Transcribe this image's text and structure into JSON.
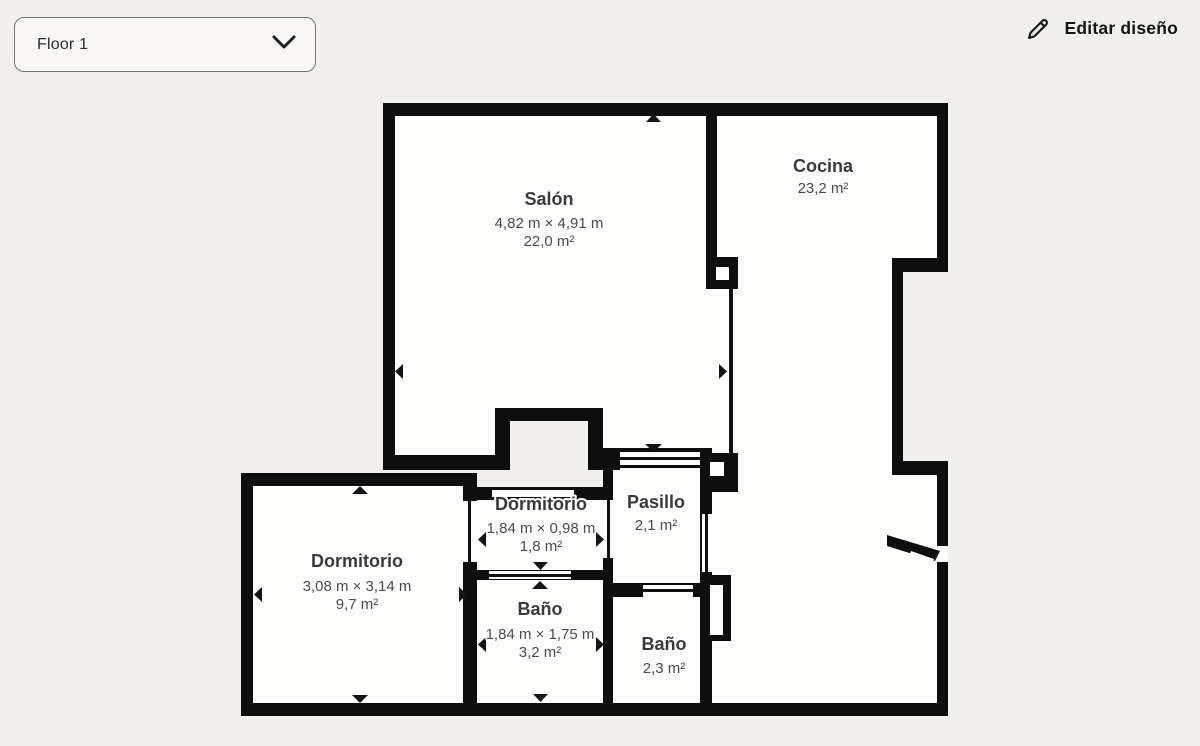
{
  "header": {
    "floor_selector": {
      "label": "Floor 1"
    },
    "edit_button": {
      "label": "Editar diseño"
    }
  },
  "icons": {
    "chevron_down": "v-shaped chevron stroke",
    "pencil": "outline pencil edit icon",
    "wall_handle_arrow": "small solid triangle pointing outward from wall"
  },
  "colors": {
    "background": "#F1F0ED",
    "wall": "#0E0E0E",
    "room_fill": "#FDFDFC",
    "room_name_text": "#3A3A3A",
    "room_dims_text": "#4A4A4A",
    "header_text": "#141414"
  },
  "floorplan": {
    "rooms": [
      {
        "id": "salon",
        "name": "Salón",
        "dimensions": "4,82 m × 4,91 m",
        "area": "22,0 m²"
      },
      {
        "id": "cocina",
        "name": "Cocina",
        "dimensions": "",
        "area": "23,2 m²"
      },
      {
        "id": "dormitorio_small",
        "name": "Dormitorio",
        "dimensions": "1,84 m × 0,98 m",
        "area": "1,8 m²"
      },
      {
        "id": "pasillo",
        "name": "Pasillo",
        "dimensions": "",
        "area": "2,1 m²"
      },
      {
        "id": "dormitorio_big",
        "name": "Dormitorio",
        "dimensions": "3,08 m × 3,14 m",
        "area": "9,7 m²"
      },
      {
        "id": "bano_1",
        "name": "Baño",
        "dimensions": "1,84 m × 1,75 m",
        "area": "3,2 m²"
      },
      {
        "id": "bano_2",
        "name": "Baño",
        "dimensions": "",
        "area": "2,3 m²"
      }
    ]
  }
}
